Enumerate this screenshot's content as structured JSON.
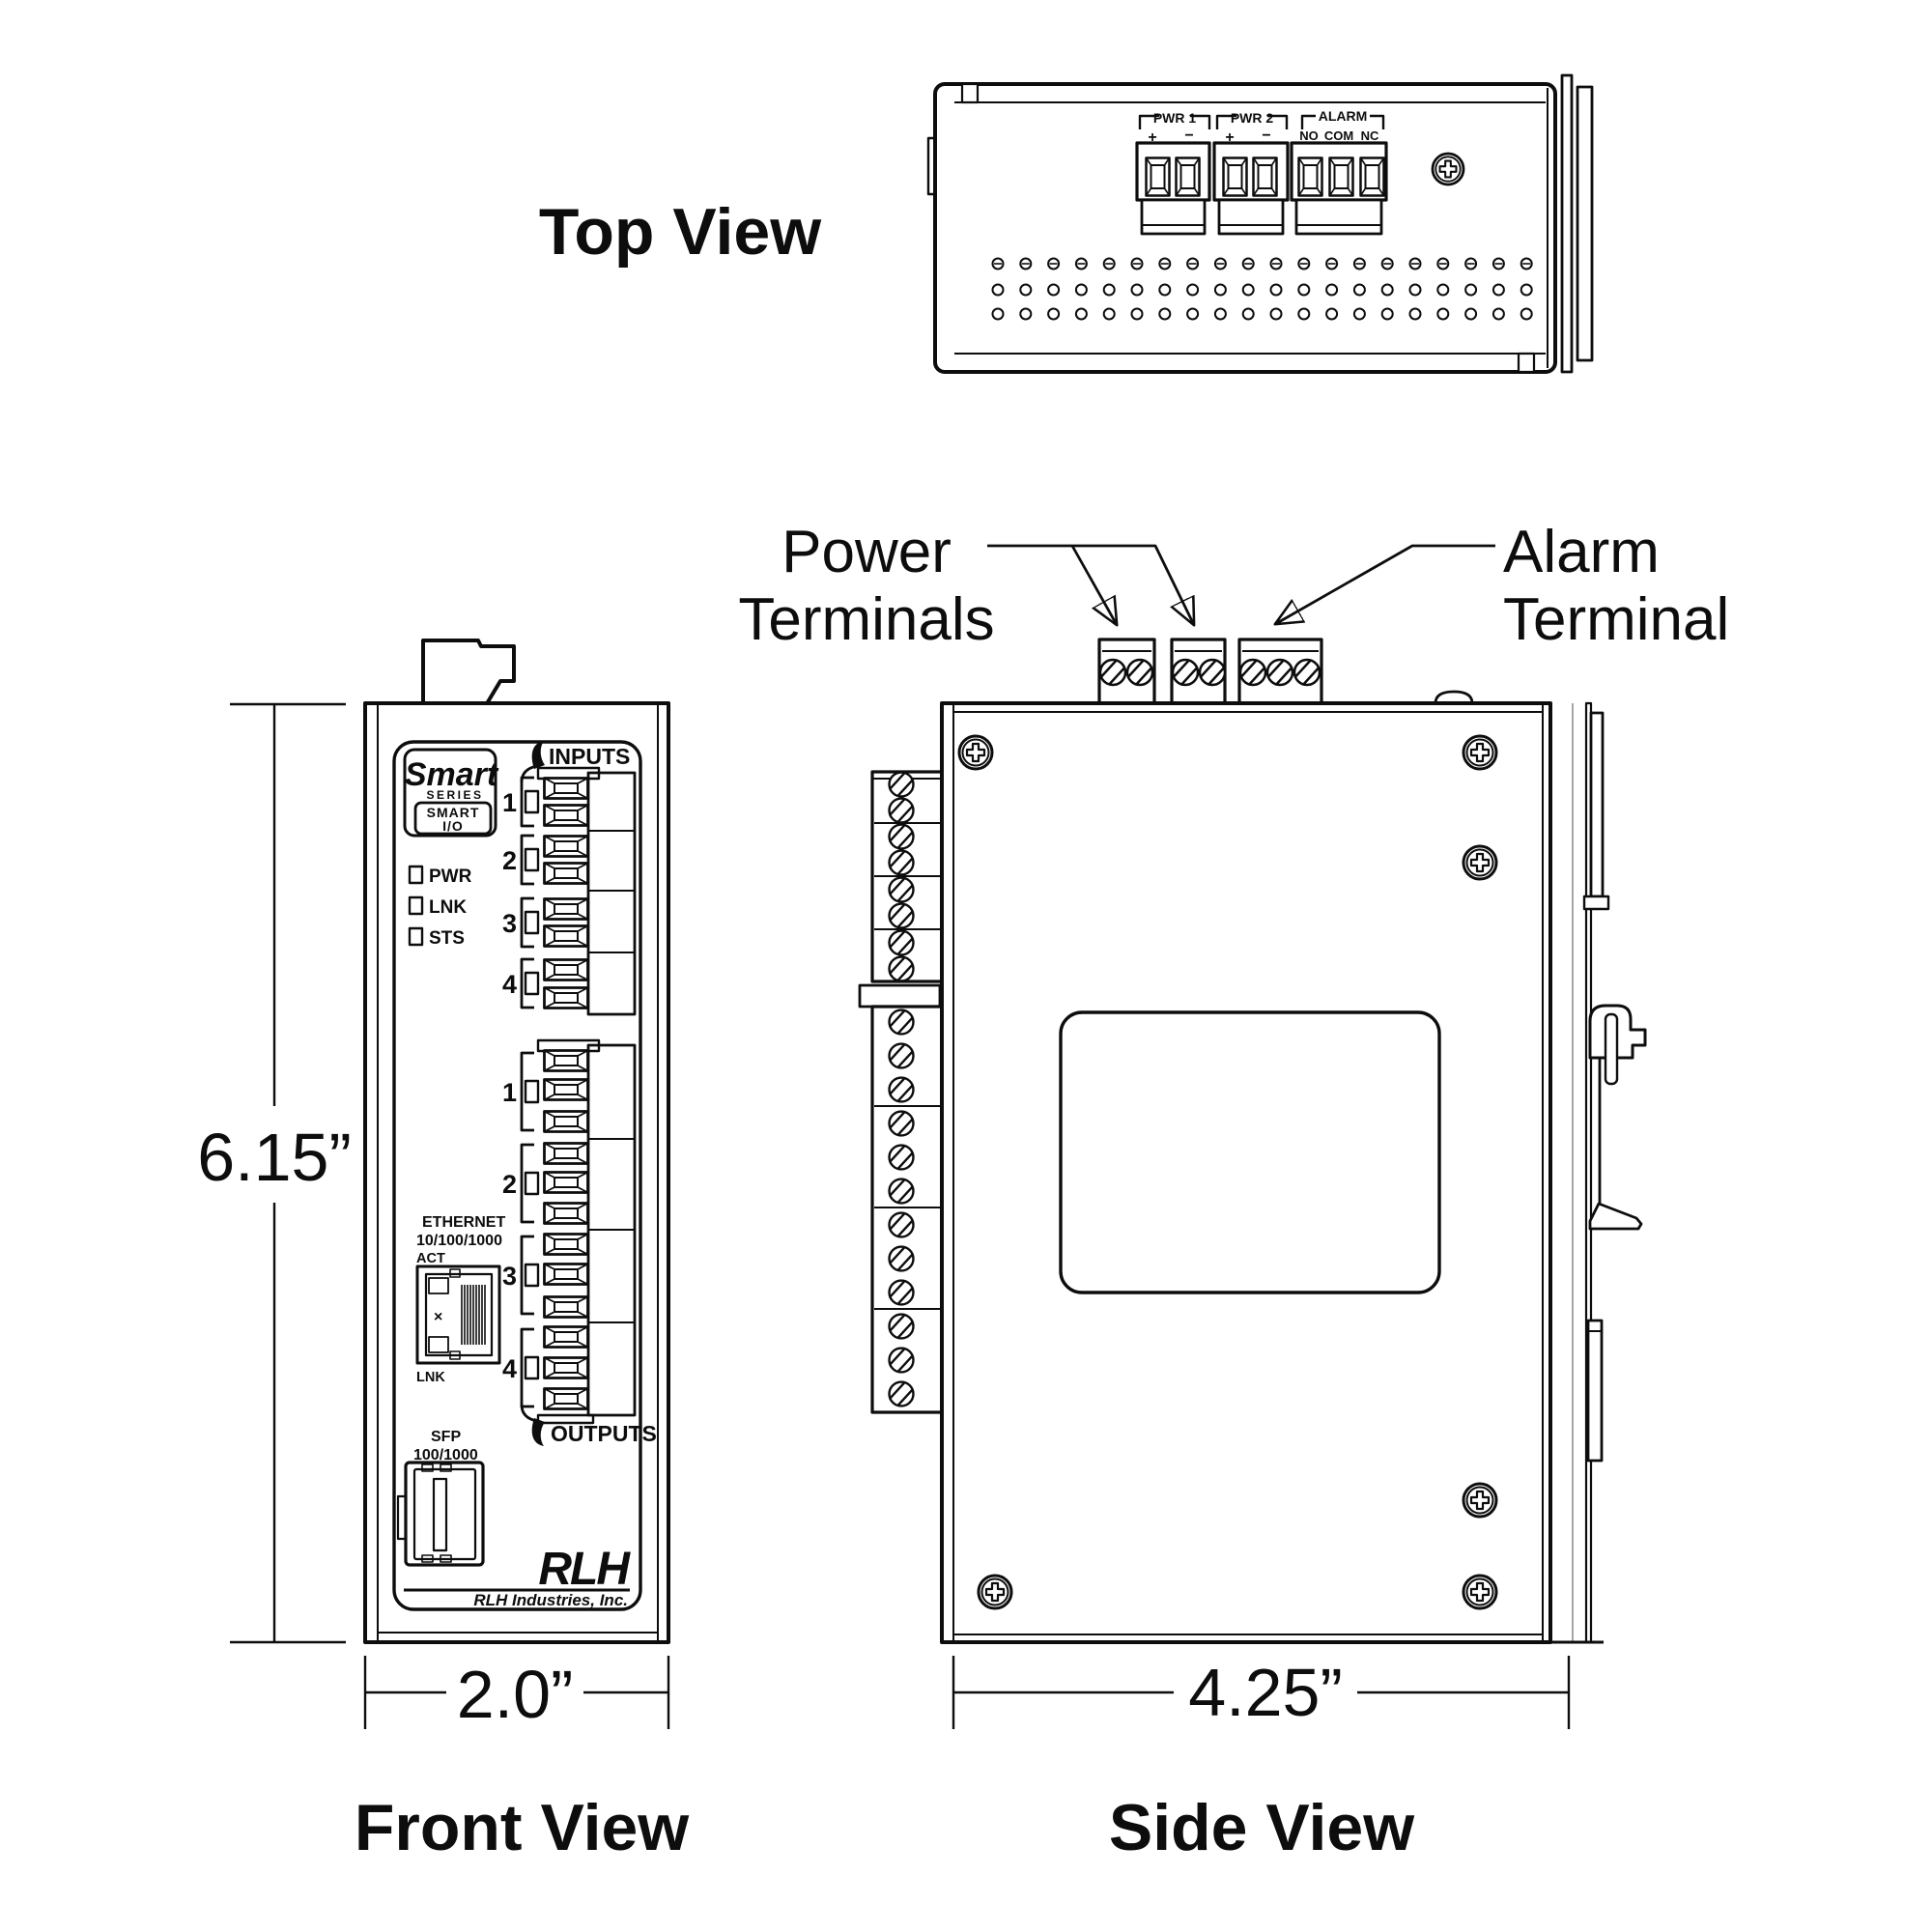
{
  "titles": {
    "top": "Top View",
    "front": "Front View",
    "side": "Side View"
  },
  "dimensions": {
    "height": "6.15”",
    "front_width": "2.0”",
    "side_width": "4.25”"
  },
  "callouts": {
    "power_line1": "Power",
    "power_line2": "Terminals",
    "alarm_line1": "Alarm",
    "alarm_line2": "Terminal"
  },
  "top_view": {
    "pwr1": {
      "label": "PWR 1",
      "pos": "+",
      "neg": "−"
    },
    "pwr2": {
      "label": "PWR 2",
      "pos": "+",
      "neg": "−"
    },
    "alarm": {
      "label": "ALARM",
      "no": "NO",
      "com": "COM",
      "nc": "NC"
    }
  },
  "front_panel": {
    "brand": {
      "script": "Smart",
      "series": "SERIES",
      "model_line1": "SMART",
      "model_line2": "I/O"
    },
    "leds": [
      {
        "label": "PWR"
      },
      {
        "label": "LNK"
      },
      {
        "label": "STS"
      }
    ],
    "inputs_label": "INPUTS",
    "outputs_label": "OUTPUTS",
    "input_channels": [
      "1",
      "2",
      "3",
      "4"
    ],
    "output_channels": [
      "1",
      "2",
      "3",
      "4"
    ],
    "ethernet": {
      "line1": "ETHERNET",
      "line2": "10/100/1000",
      "act": "ACT",
      "lnk": "LNK",
      "x_mark": "×"
    },
    "sfp": {
      "line1": "SFP",
      "line2": "100/1000"
    },
    "footer": {
      "logo": "RLH",
      "company": "RLH Industries, Inc."
    }
  },
  "geometry": {
    "vents": {
      "x0": 1033,
      "dx": 28.8,
      "cols": 20,
      "r": 5.5,
      "rows": [
        {
          "y": 273,
          "slot": true
        },
        {
          "y": 300,
          "slot": false
        },
        {
          "y": 325,
          "slot": false
        }
      ]
    },
    "tv_screws": {
      "y": 163,
      "xs": [
        1186,
        1217,
        1266,
        1297,
        1344,
        1376,
        1408
      ]
    },
    "front_input_cells": {
      "x": 563,
      "ys": [
        805,
        833,
        865,
        893,
        930,
        958,
        993,
        1022
      ]
    },
    "front_output_cells": {
      "x": 563,
      "ys": [
        1087,
        1117,
        1150,
        1183,
        1213,
        1245,
        1277,
        1308,
        1342,
        1373,
        1405,
        1437
      ]
    },
    "side_top_screws": {
      "y": 696,
      "xs": [
        1152,
        1180,
        1227,
        1255,
        1297,
        1325,
        1353
      ]
    },
    "side_left_screws_upper": {
      "cx": 933,
      "ys": [
        812,
        839,
        866,
        893,
        921,
        948,
        976,
        1003
      ]
    },
    "side_left_screws_lower": {
      "cx": 933,
      "ys": [
        1058,
        1093,
        1128,
        1163,
        1198,
        1233,
        1268,
        1303,
        1338,
        1373,
        1408,
        1443
      ]
    },
    "phillips": [
      {
        "x": 1499,
        "y": 175,
        "r": 16
      },
      {
        "x": 1010,
        "y": 779,
        "r": 17
      },
      {
        "x": 1532,
        "y": 779,
        "r": 17
      },
      {
        "x": 1532,
        "y": 893,
        "r": 17
      },
      {
        "x": 1532,
        "y": 1553,
        "r": 17
      },
      {
        "x": 1532,
        "y": 1648,
        "r": 17
      },
      {
        "x": 1030,
        "y": 1648,
        "r": 17
      }
    ]
  }
}
